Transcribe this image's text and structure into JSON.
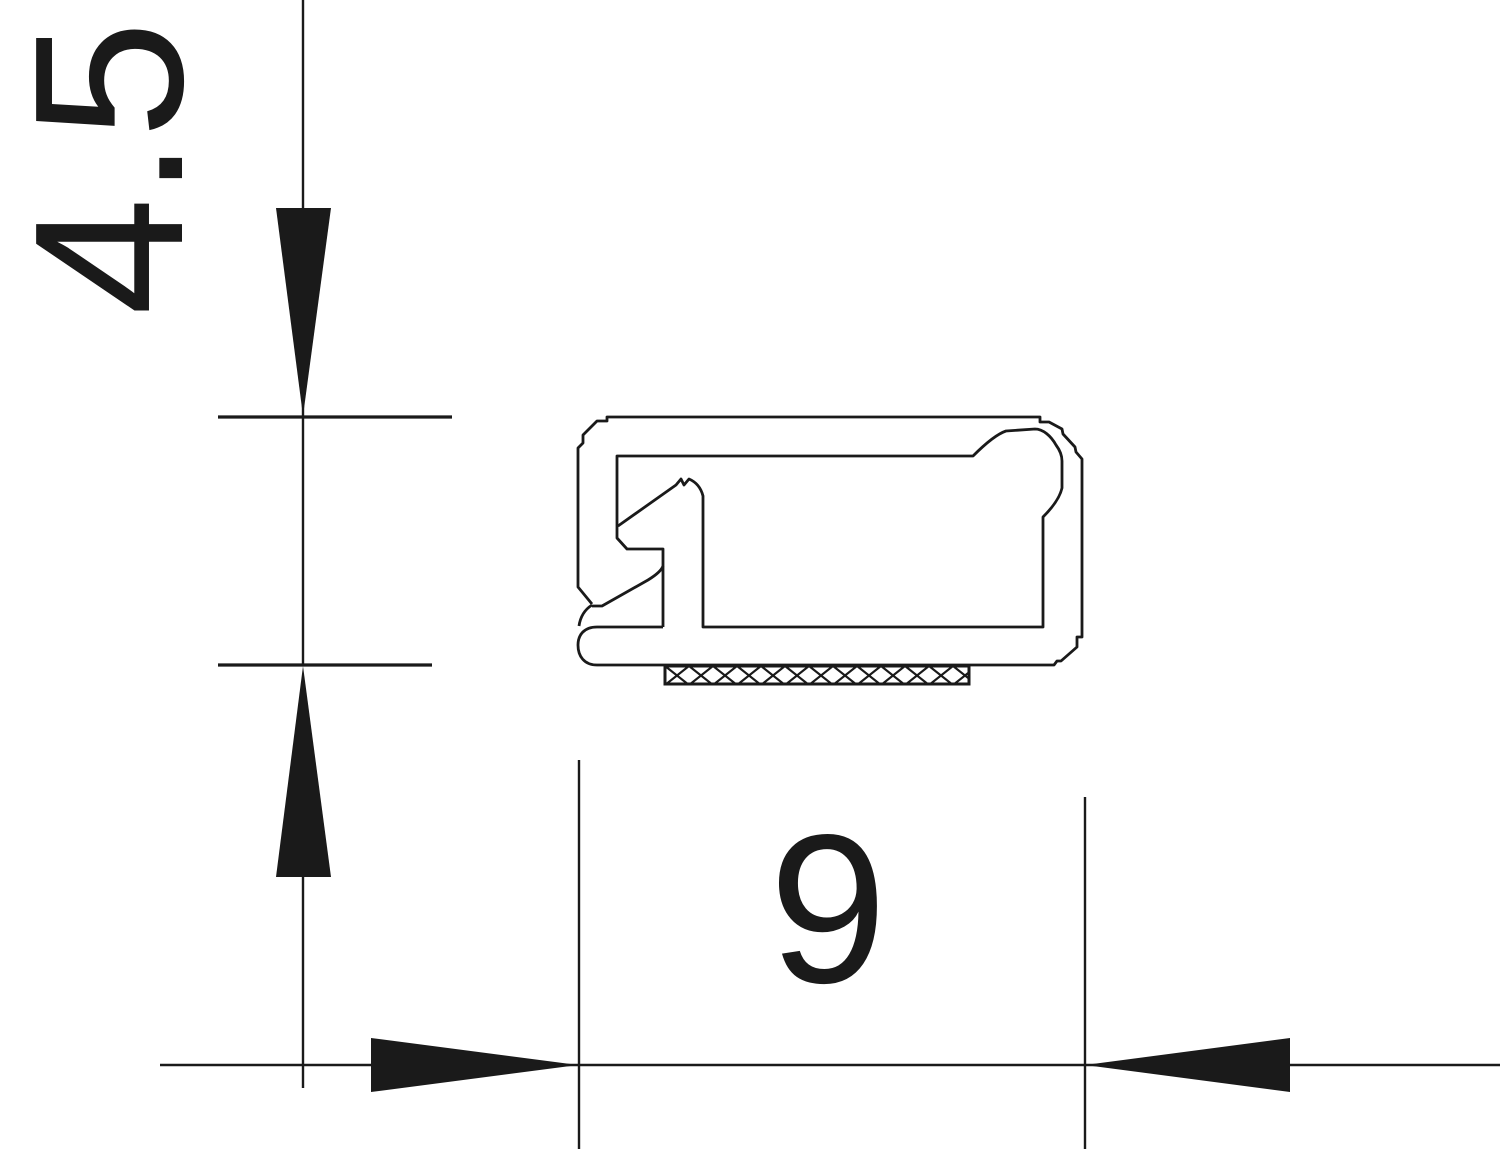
{
  "drawing": {
    "title": "seal-profile-cross-section",
    "background": "#ffffff",
    "line_color": "#1a1a1a",
    "dimensions": {
      "height": {
        "label": "4.5"
      },
      "width": {
        "label": "9"
      }
    }
  }
}
